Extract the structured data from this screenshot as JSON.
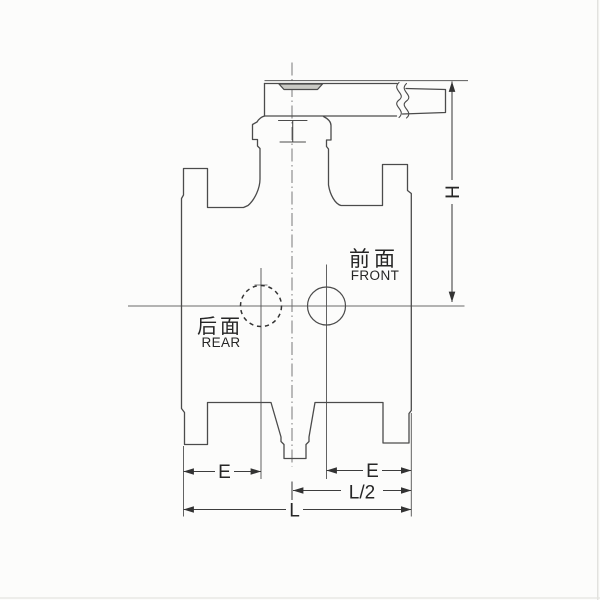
{
  "drawing": {
    "face_labels": {
      "front_cn": "前面",
      "front_en": "FRONT",
      "rear_cn": "后面",
      "rear_en": "REAR"
    },
    "dimension_labels": {
      "height": "H",
      "end_left": "E",
      "end_right": "E",
      "half_length": "L/2",
      "overall_length": "L"
    },
    "colors": {
      "outline": "#4b4b4b",
      "thin_line": "#5a5a5a",
      "text": "#262626",
      "background": "#fcfcfb"
    }
  }
}
